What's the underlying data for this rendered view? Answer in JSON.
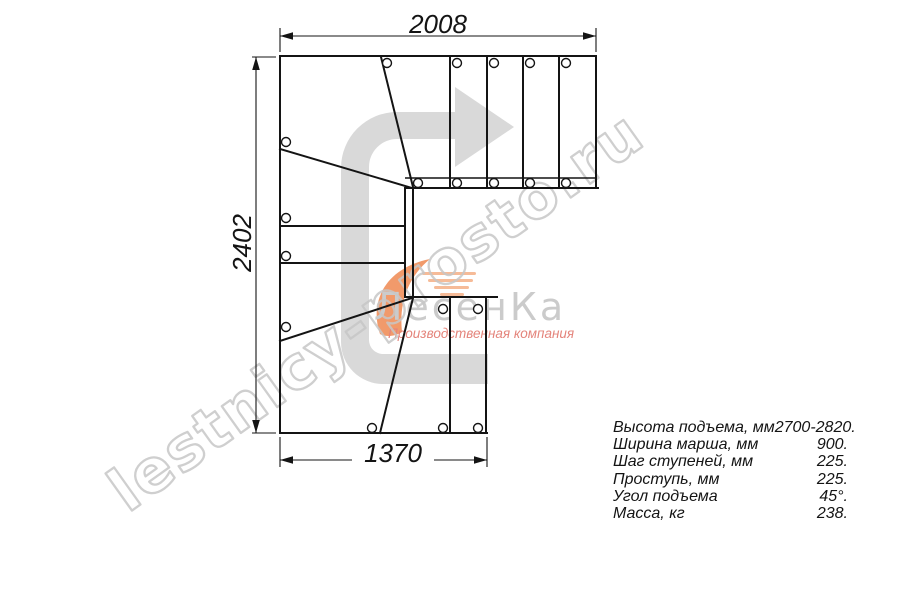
{
  "colors": {
    "line": "#141414",
    "dim": "#141414",
    "arrow_fill": "#d9d9d9",
    "watermark_stroke": "#c7c7c7",
    "logo_text": "#cbcbcb",
    "logo_orange": "#f0905c",
    "logo_subtitle": "#e4847b",
    "background": "#ffffff"
  },
  "drawing": {
    "dim_top": "2008",
    "dim_left": "2402",
    "dim_bottom": "1370"
  },
  "specs": {
    "rows": [
      {
        "label": "Высота подъема, мм",
        "value": "2700-2820."
      },
      {
        "label": "Ширина марша, мм",
        "value": "900."
      },
      {
        "label": "Шаг ступеней, мм",
        "value": "225."
      },
      {
        "label": "Проступь, мм",
        "value": "225."
      },
      {
        "label": "Угол подъема",
        "value": "45°."
      },
      {
        "label": "Масса, кг",
        "value": "238."
      }
    ]
  },
  "watermark": {
    "site": "lestnicy-prosto.ru",
    "logo_name": "ЛесенКа",
    "logo_subtitle": "Производственная компания"
  }
}
